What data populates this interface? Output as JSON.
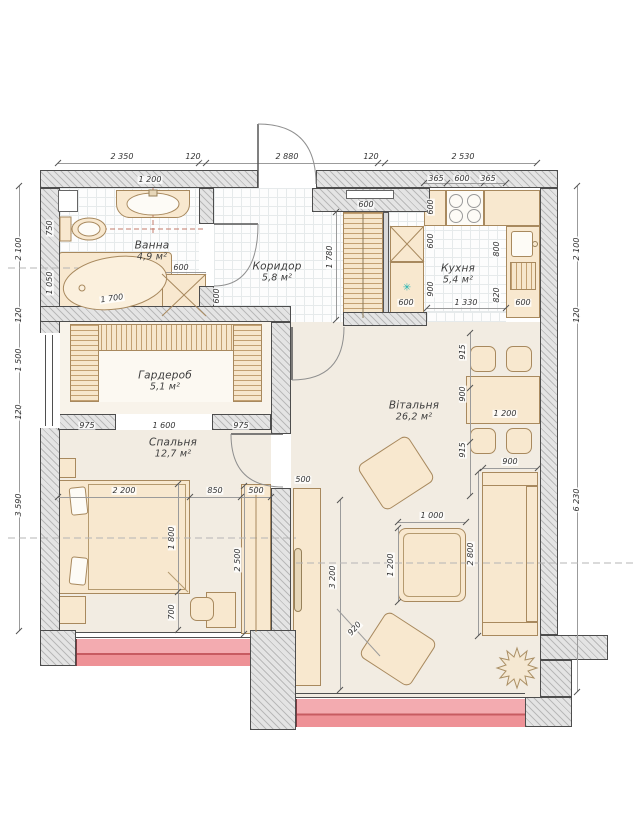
{
  "rooms": [
    {
      "name": "Ванна",
      "area": "4,9 м²"
    },
    {
      "name": "Коридор",
      "area": "5,8 м²"
    },
    {
      "name": "Кухня",
      "area": "5,4 м²"
    },
    {
      "name": "Гардероб",
      "area": "5,1 м²"
    },
    {
      "name": "Спальня",
      "area": "12,7 м²"
    },
    {
      "name": "Вітальня",
      "area": "26,2 м²"
    }
  ],
  "dims": {
    "top": [
      "2 350",
      "120",
      "2 880",
      "120",
      "2 530"
    ],
    "left": [
      "2 100",
      "120",
      "1 500",
      "120",
      "3 590"
    ],
    "right": [
      "2 100",
      "120",
      "6 230"
    ],
    "bath": {
      "basin": "1 200",
      "toilet": "750",
      "tub_w": "1 050",
      "tub_len": "1 700",
      "cab_w": "600",
      "cab_h": "600"
    },
    "corridor": {
      "shelf": "600",
      "closet": "1 780"
    },
    "kitchen": {
      "top": [
        "365",
        "600",
        "365"
      ],
      "left": [
        "600",
        "600",
        "900"
      ],
      "right": [
        "800",
        "820"
      ],
      "bottom": [
        "600",
        "1 330",
        "600"
      ]
    },
    "wardrobe": [
      "975",
      "1 600",
      "975"
    ],
    "bedroom": {
      "bed_w": "2 200",
      "gap": "850",
      "closet_w": "500",
      "bed_h": "1 800",
      "closet_h": "2 500",
      "desk": "700"
    },
    "living": {
      "tv_w": "500",
      "col": [
        "915",
        "900",
        "915"
      ],
      "table": "1 200",
      "sofa_w": "900",
      "coffee_w": "1 000",
      "coffee_h": "1 200",
      "sofa_l": "2 800",
      "len": "3 200",
      "chair": "920"
    }
  },
  "icons": {
    "washer": "✳"
  },
  "colors": {
    "balcony": "#f3abb0",
    "balcony_dark": "#c75b61",
    "furniture": "#f8e8cf",
    "accent_teal": "#1fb3b3",
    "wall_line": "#4d4d4d"
  }
}
